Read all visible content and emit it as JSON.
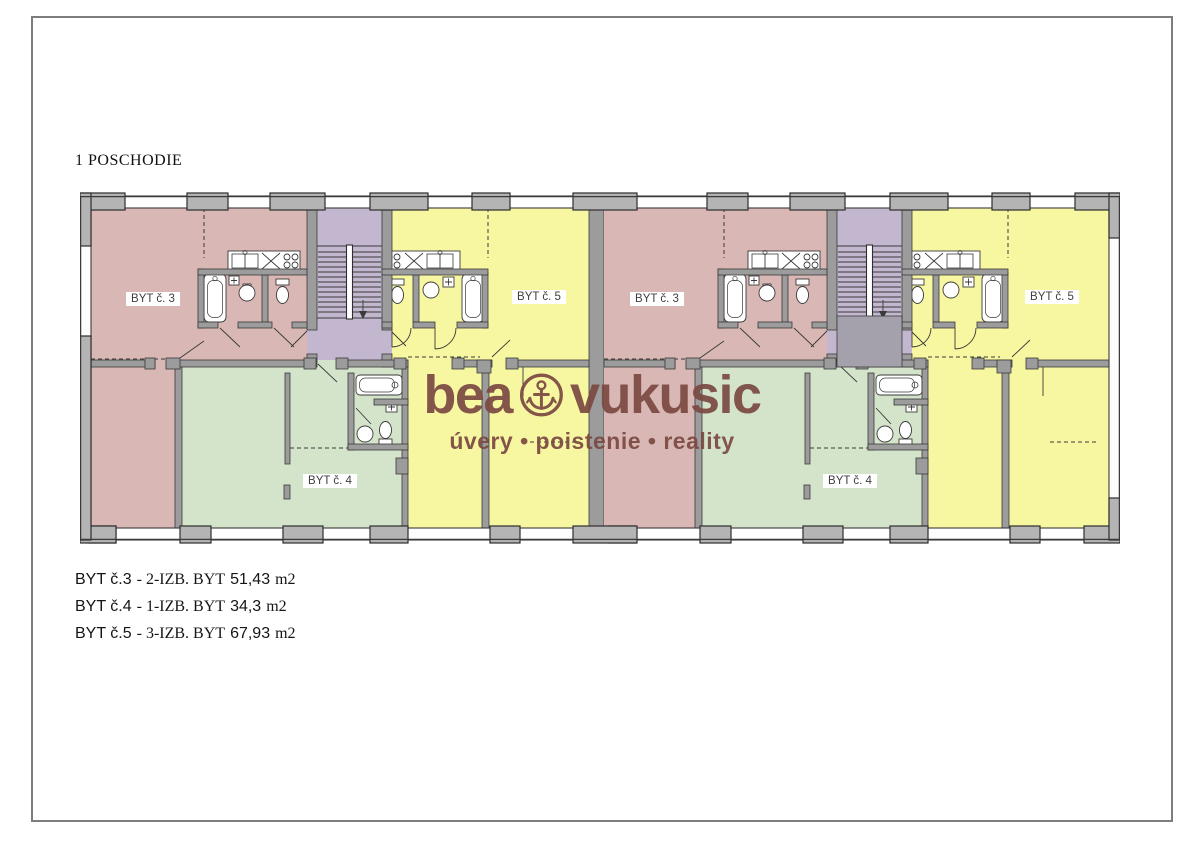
{
  "page": {
    "title": "1 POSCHODIE"
  },
  "plan": {
    "floor_name": "1 POSCHODIE",
    "labels": [
      {
        "id": "byt3-left",
        "text": "BYT č. 3"
      },
      {
        "id": "byt5-left",
        "text": "BYT č. 5"
      },
      {
        "id": "byt4-left",
        "text": "BYT č. 4"
      },
      {
        "id": "byt3-right",
        "text": "BYT č. 3"
      },
      {
        "id": "byt5-right",
        "text": "BYT č. 5"
      },
      {
        "id": "byt4-right",
        "text": "BYT č. 4"
      }
    ],
    "colors": {
      "apartment3_pink": "#d9b7b4",
      "apartment4_green": "#d4e4ca",
      "apartment5_yellow": "#f8f7a1",
      "stairwell_purple": "#c3b7d0",
      "vestibule_gray": "#a4a1ac",
      "walls_gray": "#9c9c9c",
      "window_gray": "#b4b4b4"
    }
  },
  "watermark": {
    "brand_left": "bea",
    "brand_right": "vukusic",
    "anchor_icon": "anchor-in-circle",
    "tagline": "úvery • poistenie • reality",
    "color": "#7b4a43"
  },
  "legend": {
    "items": [
      {
        "apartment": "BYT č.3",
        "description": "- 2-IZB. BYT",
        "area": "51,43",
        "unit": "m2"
      },
      {
        "apartment": "BYT č.4",
        "description": "- 1-IZB. BYT",
        "area": "34,3",
        "unit": "m2"
      },
      {
        "apartment": "BYT č.5",
        "description": "- 3-IZB. BYT",
        "area": "67,93",
        "unit": "m2"
      }
    ]
  }
}
